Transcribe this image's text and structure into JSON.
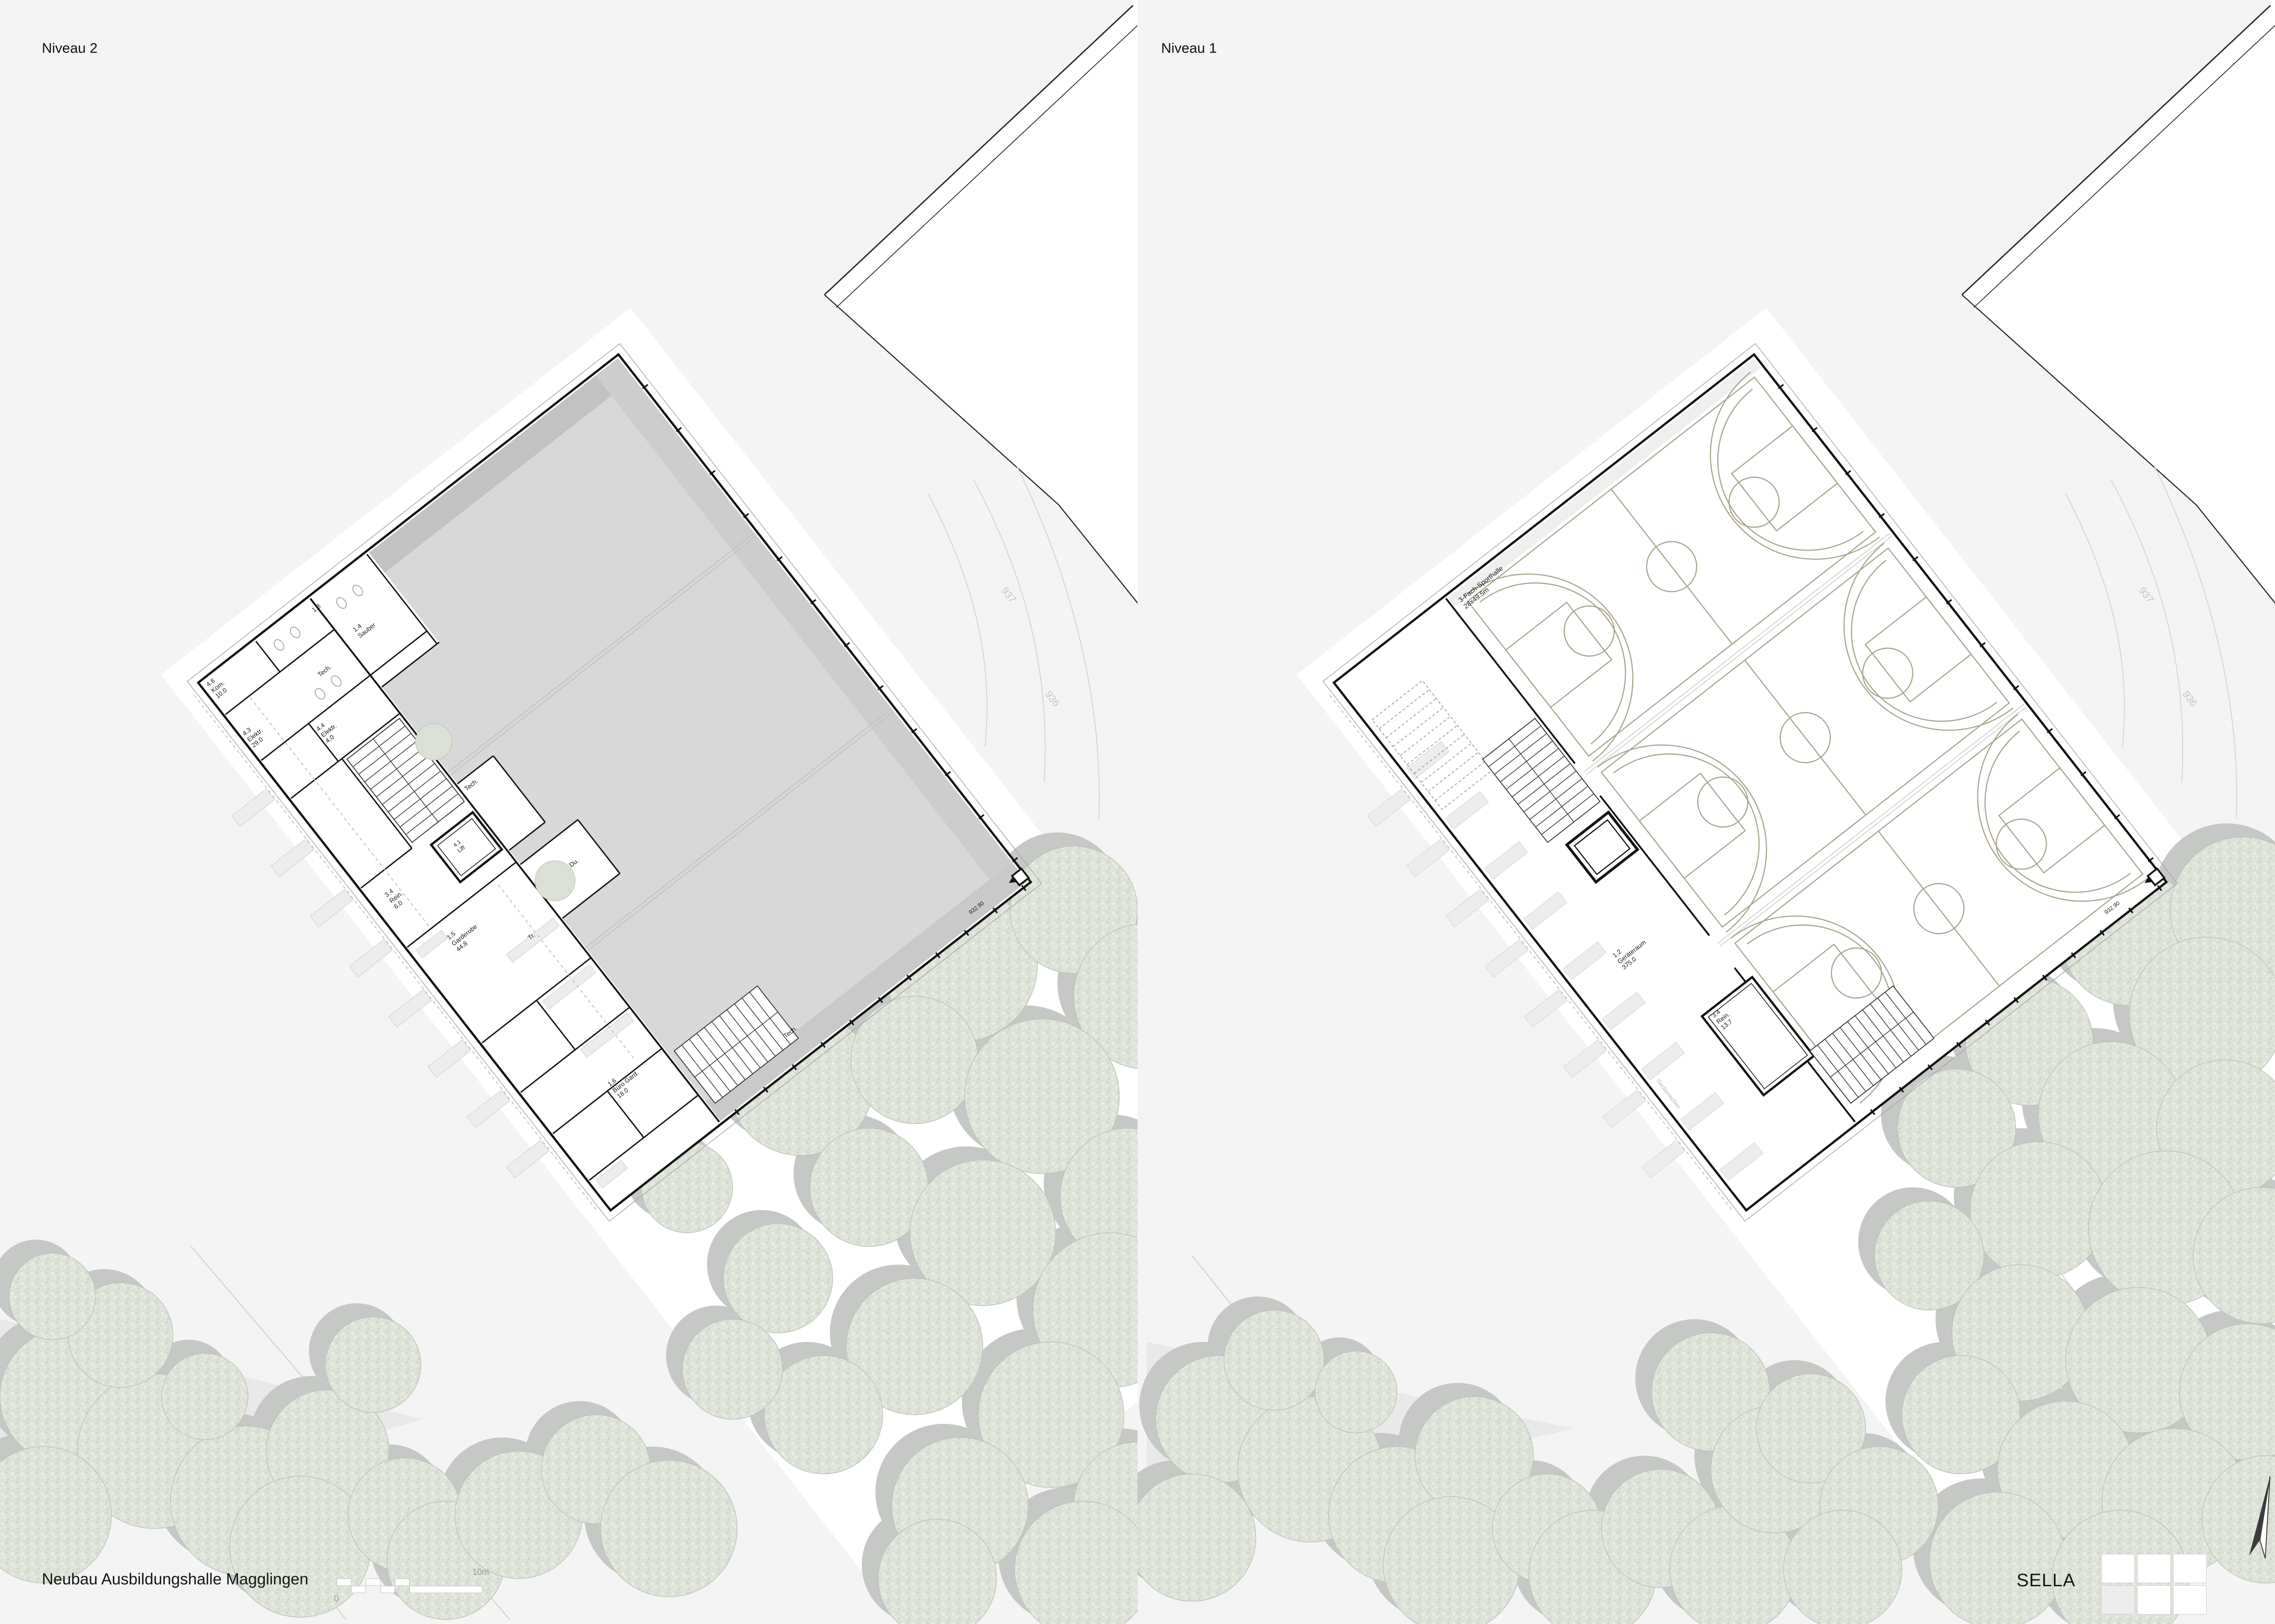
{
  "header": {
    "left_title": "Niveau 2",
    "right_title": "Niveau 1"
  },
  "niveau2": {
    "rooms": [
      {
        "a": "4.6",
        "b": "Kom.",
        "c": "10.0"
      },
      {
        "a": "1.8"
      },
      {
        "a": "Tech."
      },
      {
        "a": "1.4",
        "b": "Sauber"
      },
      {
        "a": "4.3",
        "b": "Elektr.",
        "c": "29.0"
      },
      {
        "a": "4.4",
        "b": "Elektr.",
        "c": "4.0"
      },
      {
        "a": "Tech."
      },
      {
        "a": "4.1",
        "b": "Lift"
      },
      {
        "a": "3.4",
        "b": "Rein.",
        "c": "6.0"
      },
      {
        "a": "1.5",
        "b": "Garderobe",
        "c": "44.8"
      },
      {
        "a": "Du."
      },
      {
        "a": "Tr."
      },
      {
        "a": "1.6",
        "b": "Büro Gard.",
        "c": "18.0"
      },
      {
        "a": "Tech."
      }
    ],
    "elevation": "932.90",
    "contours": [
      "937",
      "936"
    ]
  },
  "niveau1": {
    "hall_label": {
      "a": "3-Fach-Sporthalle",
      "b": "28x49.5m"
    },
    "rooms": [
      {
        "a": "1.2",
        "b": "Geräteraum",
        "c": "375.0"
      },
      {
        "a": "3.4",
        "b": "Rein.",
        "c": "13.7"
      }
    ],
    "wall_label": "Gerätenischen",
    "elevation": "932.90",
    "contours": [
      "937",
      "936"
    ]
  },
  "footer": {
    "project_title": "Neubau Ausbildungshalle Magglingen",
    "scale_start": "0",
    "scale_end": "10m",
    "architect": "SELLA"
  },
  "colors": {
    "wall": "#141414",
    "hall_roof": "#d8d8d8",
    "court_lines": "#a9a58d",
    "tree_canopy": "#dde2d8",
    "tree_shadow": "#c6c8c5",
    "background": "#f4f4f4"
  }
}
